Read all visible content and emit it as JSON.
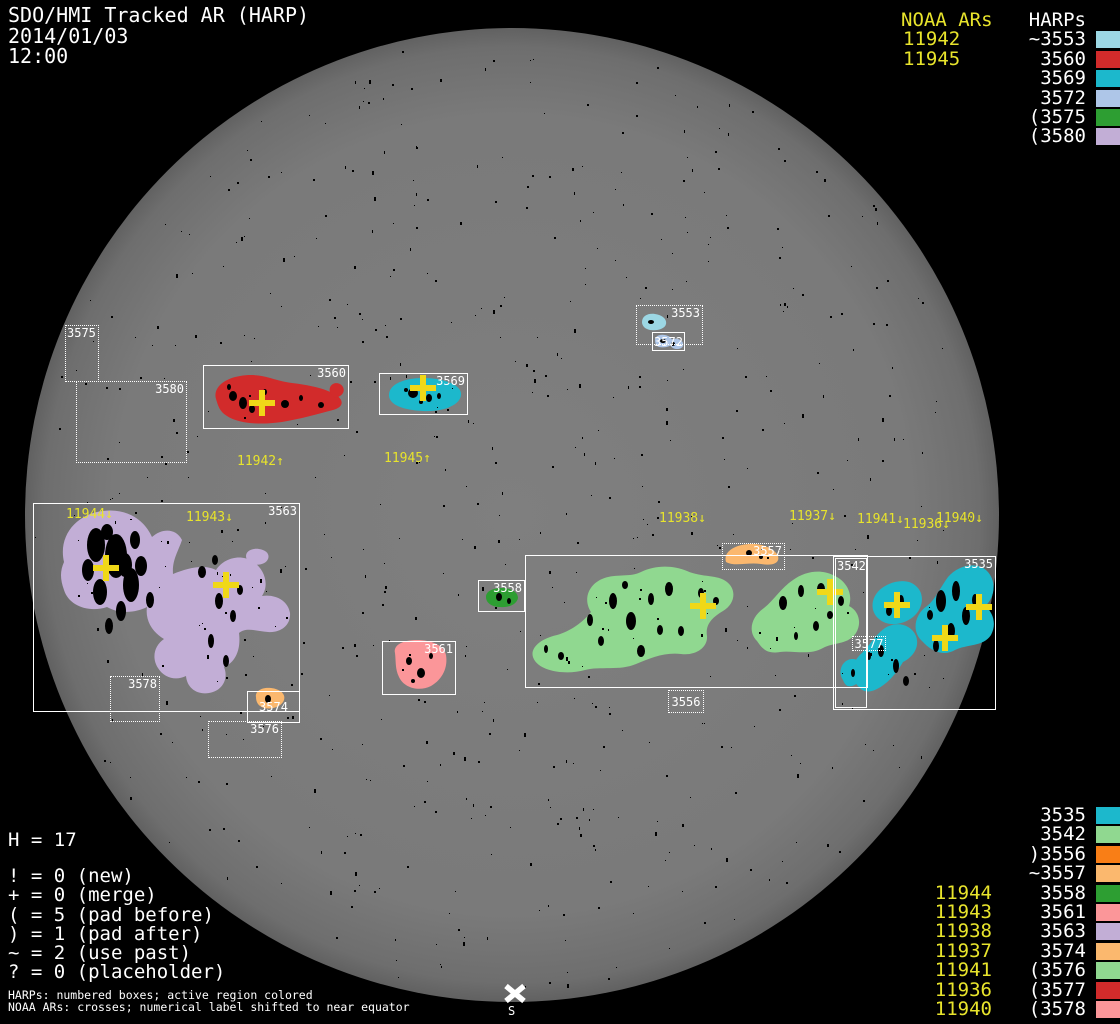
{
  "title": {
    "line1": "SDO/HMI Tracked AR (HARP)",
    "line2": "2014/01/03",
    "line3": "12:00"
  },
  "colors": {
    "background": "#000000",
    "disk_center": "#7f7f7f",
    "disk_edge": "#636363",
    "box_border": "#ffffff",
    "label_text": "#ffffff",
    "noaa_yellow": "#e8e42c",
    "cross_yellow": "#f0d818"
  },
  "top_right": {
    "noaa_header": "NOAA ARs",
    "noaa_items": [
      "11942",
      "11945"
    ],
    "harps_header": "HARPs",
    "harps_items": [
      {
        "label": "~3553",
        "color": "#9cd7e4"
      },
      {
        "label": "3560",
        "color": "#d22b2b"
      },
      {
        "label": "3569",
        "color": "#1cb8cc"
      },
      {
        "label": "3572",
        "color": "#aec6e8"
      },
      {
        "label": "(3575",
        "color": "#2d9e32"
      },
      {
        "label": "(3580",
        "color": "#c2aed6"
      }
    ]
  },
  "bottom_right": {
    "harps_items": [
      {
        "label": "3535",
        "color": "#1cb8cc",
        "noaa": ""
      },
      {
        "label": "3542",
        "color": "#90d890",
        "noaa": ""
      },
      {
        "label": ")3556",
        "color": "#f97e16",
        "noaa": ""
      },
      {
        "label": "~3557",
        "color": "#fbb86e",
        "noaa": ""
      },
      {
        "label": "3558",
        "color": "#2d9e32",
        "noaa": "11944"
      },
      {
        "label": "3561",
        "color": "#fb9699",
        "noaa": "11943"
      },
      {
        "label": "3563",
        "color": "#c2aed6",
        "noaa": "11938"
      },
      {
        "label": "3574",
        "color": "#fbb86e",
        "noaa": "11937"
      },
      {
        "label": "(3576",
        "color": "#90d890",
        "noaa": "11941"
      },
      {
        "label": "(3577",
        "color": "#d22b2b",
        "noaa": "11936"
      },
      {
        "label": "(3578",
        "color": "#fb9699",
        "noaa": "11940"
      }
    ]
  },
  "stats": {
    "h_line": "H = 17",
    "lines": [
      "! = 0 (new)",
      "+ = 0 (merge)",
      "( = 5 (pad before)",
      ") = 1 (pad after)",
      "~ = 2 (use past)",
      "? = 0 (placeholder)"
    ]
  },
  "footer": {
    "line1": "HARPs: numbered boxes; active region colored",
    "line2": "NOAA ARs: crosses; numerical label shifted to near equator"
  },
  "south_marker": {
    "label": "S"
  },
  "disk": {
    "cx": 512,
    "cy": 515,
    "r": 487
  },
  "boxes": [
    {
      "id": "3575",
      "label": "3575",
      "x": 65,
      "y": 325,
      "w": 34,
      "h": 57,
      "style": "dotted",
      "label_pos": "tl"
    },
    {
      "id": "3580",
      "label": "3580",
      "x": 76,
      "y": 381,
      "w": 111,
      "h": 82,
      "style": "dotted",
      "label_pos": "tr"
    },
    {
      "id": "3553",
      "label": "3553",
      "x": 636,
      "y": 305,
      "w": 67,
      "h": 40,
      "style": "dotted",
      "label_pos": "tr"
    },
    {
      "id": "3572",
      "label": "3572",
      "x": 652,
      "y": 332,
      "w": 33,
      "h": 19,
      "style": "solid",
      "label_pos": "c"
    },
    {
      "id": "3560",
      "label": "3560",
      "x": 203,
      "y": 365,
      "w": 146,
      "h": 64,
      "style": "solid",
      "label_pos": "tr"
    },
    {
      "id": "3569",
      "label": "3569",
      "x": 379,
      "y": 373,
      "w": 89,
      "h": 42,
      "style": "solid",
      "label_pos": "tr"
    },
    {
      "id": "3563",
      "label": "3563",
      "x": 33,
      "y": 503,
      "w": 267,
      "h": 209,
      "style": "solid",
      "label_pos": "tr"
    },
    {
      "id": "3578",
      "label": "3578",
      "x": 110,
      "y": 676,
      "w": 50,
      "h": 46,
      "style": "dotted",
      "label_pos": "tr"
    },
    {
      "id": "3574",
      "label": "3574",
      "x": 247,
      "y": 691,
      "w": 53,
      "h": 32,
      "style": "solid",
      "label_pos": "c"
    },
    {
      "id": "3576",
      "label": "3576",
      "x": 208,
      "y": 721,
      "w": 74,
      "h": 37,
      "style": "dotted",
      "label_pos": "tr"
    },
    {
      "id": "3561",
      "label": "3561",
      "x": 382,
      "y": 641,
      "w": 74,
      "h": 54,
      "style": "solid",
      "label_pos": "tr"
    },
    {
      "id": "3558",
      "label": "3558",
      "x": 478,
      "y": 580,
      "w": 47,
      "h": 32,
      "style": "solid",
      "label_pos": "tr"
    },
    {
      "id": "3556-region",
      "label": "",
      "x": 525,
      "y": 555,
      "w": 343,
      "h": 133,
      "style": "solid",
      "label_pos": "none"
    },
    {
      "id": "3556",
      "label": "3556",
      "x": 668,
      "y": 690,
      "w": 36,
      "h": 23,
      "style": "dotted",
      "label_pos": "c"
    },
    {
      "id": "3557",
      "label": "3557",
      "x": 722,
      "y": 543,
      "w": 63,
      "h": 27,
      "style": "dotted",
      "label_pos": "tr"
    },
    {
      "id": "3535",
      "label": "3535",
      "x": 833,
      "y": 556,
      "w": 163,
      "h": 154,
      "style": "solid",
      "label_pos": "tr"
    },
    {
      "id": "3542",
      "label": "3542",
      "x": 835,
      "y": 558,
      "w": 32,
      "h": 150,
      "style": "solid",
      "label_pos": "tl"
    },
    {
      "id": "3577",
      "label": "3577",
      "x": 852,
      "y": 636,
      "w": 34,
      "h": 15,
      "style": "dotted",
      "label_pos": "c"
    }
  ],
  "crosses": [
    {
      "x": 262,
      "y": 403
    },
    {
      "x": 423,
      "y": 388
    },
    {
      "x": 106,
      "y": 568
    },
    {
      "x": 226,
      "y": 585
    },
    {
      "x": 703,
      "y": 606
    },
    {
      "x": 830,
      "y": 592
    },
    {
      "x": 897,
      "y": 605
    },
    {
      "x": 979,
      "y": 607
    },
    {
      "x": 945,
      "y": 638
    }
  ],
  "noaa_disk_labels": [
    {
      "text": "11942↑",
      "x": 237,
      "y": 455
    },
    {
      "text": "11945↑",
      "x": 384,
      "y": 452
    },
    {
      "text": "11944↓",
      "x": 66,
      "y": 508
    },
    {
      "text": "11943↓",
      "x": 186,
      "y": 511
    },
    {
      "text": "11938↓",
      "x": 659,
      "y": 512
    },
    {
      "text": "11937↓",
      "x": 789,
      "y": 510
    },
    {
      "text": "11941↓",
      "x": 857,
      "y": 513
    },
    {
      "text": "11936↓",
      "x": 903,
      "y": 518
    },
    {
      "text": "11940↓",
      "x": 936,
      "y": 512
    }
  ],
  "blobs": [
    {
      "id": "ar-3553",
      "fill": "#9cd7e4",
      "d": "M642,322 C642,316 648,313 655,314 C662,315 667,319 666,324 C665,329 657,331 650,330 C645,329 642,326 642,322 Z"
    },
    {
      "id": "ar-3572-a",
      "fill": "#aec6e8",
      "d": "M655,340 C655,336 660,334 665,335 C670,336 673,339 672,343 C671,347 664,348 659,347 C656,346 655,343 655,340 Z"
    },
    {
      "id": "ar-3572-b",
      "fill": "#aec6e8",
      "d": "M670,342 C670,339 674,338 678,339 C682,340 684,343 683,346 C682,349 676,350 673,348 C671,347 670,345 670,342 Z"
    },
    {
      "id": "ar-3560",
      "fill": "#d22b2b",
      "d": "M216,399 C213,389 222,379 240,376 C262,372 274,381 292,383 C308,385 325,388 336,395 C344,400 344,407 333,410 C318,414 300,419 282,422 C261,425 239,424 227,416 C219,411 218,405 216,399 Z"
    },
    {
      "id": "ar-3560-tail",
      "fill": "#d22b2b",
      "d": "M330,392 C328,386 334,381 340,384 C345,387 345,393 340,396 C335,399 332,397 330,392 Z"
    },
    {
      "id": "ar-3569",
      "fill": "#1cb8cc",
      "d": "M389,396 C388,385 403,378 423,378 C444,378 462,385 461,395 C460,405 444,412 423,411 C403,410 390,405 389,396 Z"
    },
    {
      "id": "ar-3563",
      "fill": "#c2aed6",
      "d": "M64,562 C58,536 76,514 103,511 C126,508 144,519 152,537 C162,528 176,528 182,540 C178,552 172,560 173,574 C188,568 204,564 216,570 C224,558 240,554 252,561 C264,568 270,584 262,596 C276,594 288,601 290,613 C291,625 281,633 268,632 C256,631 246,627 239,633 C241,649 236,662 224,667 C229,679 222,691 209,693 C197,695 187,688 186,676 C176,681 164,678 158,668 C151,657 155,645 164,639 C152,632 145,620 147,607 C135,613 119,614 107,607 C89,613 69,606 64,590 C60,579 60,571 64,562 Z"
    },
    {
      "id": "ar-3563-b",
      "fill": "#c2aed6",
      "d": "M246,556 C246,551 252,548 259,549 C266,550 270,554 268,559 C266,564 258,566 252,564 C248,562 246,559 246,556 Z"
    },
    {
      "id": "ar-3561",
      "fill": "#fb9699",
      "d": "M395,653 C393,645 403,640 417,640 C431,640 444,645 446,655 C448,667 443,679 431,686 C419,692 404,688 399,677 C395,669 396,661 395,653 Z"
    },
    {
      "id": "ar-3558",
      "fill": "#2d9e32",
      "d": "M486,597 C486,591 493,588 502,588 C511,588 518,592 518,598 C517,604 509,608 500,607 C492,607 486,603 486,597 Z"
    },
    {
      "id": "ar-3556-a",
      "fill": "#90d890",
      "d": "M535,661 C527,650 539,639 557,635 C571,631 583,622 591,612 C583,600 588,585 602,579 C616,573 629,578 641,572 C655,565 673,565 687,571 C703,578 717,574 727,582 C737,590 735,604 723,611 C713,617 705,624 707,636 C708,648 695,656 681,654 C665,652 650,658 636,664 C620,671 600,666 585,670 C567,675 543,672 535,661 Z"
    },
    {
      "id": "ar-3556-b",
      "fill": "#90d890",
      "d": "M757,641 C747,631 752,616 764,608 C774,600 781,588 793,580 C805,571 821,569 833,575 C847,581 853,594 849,606 C859,611 862,623 856,633 C848,645 834,642 823,648 C809,656 792,650 780,652 C768,654 763,650 757,641 Z"
    },
    {
      "id": "ar-3557",
      "fill": "#fbb86e",
      "d": "M726,562 C723,552 734,545 749,544 C763,543 775,549 778,556 C780,563 773,566 761,564 C747,562 735,567 726,562 Z"
    },
    {
      "id": "ar-3574",
      "fill": "#fbb86e",
      "d": "M256,697 C255,691 262,687 271,688 C280,689 286,694 284,700 C282,706 273,710 264,708 C258,706 256,702 256,697 Z"
    },
    {
      "id": "ar-3535-a",
      "fill": "#1cb8cc",
      "d": "M879,619 C869,611 871,596 882,588 C893,580 909,578 917,587 C925,595 923,609 913,617 C903,625 888,627 879,619 Z"
    },
    {
      "id": "ar-3535-b",
      "fill": "#1cb8cc",
      "d": "M922,641 C911,631 915,614 927,606 C935,600 940,588 948,577 C958,565 977,561 987,571 C997,581 995,598 985,606 C993,612 997,624 991,635 C983,647 967,644 955,650 C943,657 931,651 922,641 Z"
    },
    {
      "id": "ar-3535-c",
      "fill": "#1cb8cc",
      "d": "M859,687 C848,677 852,661 862,653 C870,645 875,635 885,628 C896,621 911,624 916,636 C920,647 913,657 903,662 C897,672 889,683 877,689 C869,693 863,692 859,687 Z"
    },
    {
      "id": "ar-3535-d",
      "fill": "#1cb8cc",
      "d": "M843,680 C838,673 841,663 848,660 C855,657 862,661 863,669 C864,677 859,684 852,686 C847,687 845,685 843,680 Z"
    }
  ],
  "sunspots": [
    [
      96,
      545,
      9,
      17
    ],
    [
      116,
      556,
      11,
      22
    ],
    [
      131,
      585,
      8,
      17
    ],
    [
      100,
      592,
      7,
      13
    ],
    [
      88,
      570,
      6,
      11
    ],
    [
      141,
      566,
      6,
      10
    ],
    [
      121,
      611,
      5,
      10
    ],
    [
      109,
      626,
      4,
      8
    ],
    [
      135,
      540,
      5,
      9
    ],
    [
      107,
      532,
      6,
      8
    ],
    [
      150,
      600,
      4,
      8
    ],
    [
      125,
      565,
      7,
      12
    ],
    [
      219,
      601,
      4,
      8
    ],
    [
      233,
      616,
      3,
      6
    ],
    [
      211,
      641,
      3,
      7
    ],
    [
      226,
      661,
      3,
      6
    ],
    [
      202,
      572,
      4,
      6
    ],
    [
      240,
      590,
      3,
      5
    ],
    [
      215,
      560,
      3,
      5
    ],
    [
      233,
      396,
      4,
      5
    ],
    [
      243,
      403,
      4,
      6
    ],
    [
      252,
      409,
      3,
      4
    ],
    [
      285,
      404,
      4,
      4
    ],
    [
      301,
      398,
      2,
      3
    ],
    [
      321,
      405,
      3,
      3
    ],
    [
      229,
      387,
      2,
      3
    ],
    [
      265,
      392,
      2,
      3
    ],
    [
      413,
      393,
      5,
      5
    ],
    [
      429,
      398,
      3,
      4
    ],
    [
      439,
      396,
      2,
      3
    ],
    [
      406,
      390,
      2,
      2
    ],
    [
      421,
      402,
      2,
      2
    ],
    [
      613,
      601,
      4,
      8
    ],
    [
      631,
      621,
      5,
      9
    ],
    [
      651,
      599,
      3,
      6
    ],
    [
      669,
      589,
      4,
      7
    ],
    [
      701,
      593,
      3,
      5
    ],
    [
      641,
      651,
      4,
      6
    ],
    [
      601,
      641,
      3,
      5
    ],
    [
      681,
      631,
      3,
      5
    ],
    [
      561,
      656,
      3,
      4
    ],
    [
      546,
      649,
      2,
      4
    ],
    [
      716,
      601,
      3,
      4
    ],
    [
      590,
      620,
      3,
      6
    ],
    [
      660,
      630,
      3,
      5
    ],
    [
      625,
      585,
      3,
      4
    ],
    [
      783,
      603,
      4,
      7
    ],
    [
      801,
      591,
      3,
      6
    ],
    [
      821,
      589,
      4,
      6
    ],
    [
      841,
      601,
      3,
      5
    ],
    [
      816,
      626,
      3,
      5
    ],
    [
      796,
      636,
      2,
      4
    ],
    [
      830,
      615,
      3,
      4
    ],
    [
      749,
      553,
      3,
      3
    ],
    [
      761,
      557,
      2,
      2
    ],
    [
      409,
      661,
      3,
      4
    ],
    [
      421,
      673,
      4,
      5
    ],
    [
      431,
      656,
      2,
      3
    ],
    [
      413,
      681,
      2,
      2
    ],
    [
      499,
      597,
      3,
      4
    ],
    [
      509,
      601,
      2,
      3
    ],
    [
      268,
      699,
      3,
      4
    ],
    [
      901,
      601,
      3,
      6
    ],
    [
      889,
      611,
      3,
      5
    ],
    [
      941,
      601,
      5,
      11
    ],
    [
      956,
      591,
      4,
      10
    ],
    [
      966,
      616,
      4,
      9
    ],
    [
      951,
      631,
      4,
      8
    ],
    [
      936,
      646,
      3,
      6
    ],
    [
      881,
      651,
      3,
      6
    ],
    [
      896,
      666,
      3,
      7
    ],
    [
      906,
      681,
      3,
      5
    ],
    [
      869,
      656,
      2,
      4
    ],
    [
      853,
      673,
      2,
      4
    ],
    [
      975,
      600,
      3,
      6
    ],
    [
      930,
      615,
      3,
      5
    ],
    [
      651,
      322,
      3,
      2
    ],
    [
      663,
      341,
      3,
      2
    ],
    [
      673,
      344,
      2,
      2
    ]
  ],
  "speckles": {
    "seed": 1337,
    "count": 640,
    "r": 478
  },
  "chart_data": {
    "type": "scatter",
    "title": "SDO/HMI Tracked AR (HARP)",
    "date": "2014/01/03",
    "time": "12:00",
    "h_count": 17,
    "status_counts": {
      "new": 0,
      "merge": 0,
      "pad_before": 5,
      "pad_after": 1,
      "use_past": 2,
      "placeholder": 0
    },
    "harps": [
      {
        "harp": "3553",
        "prefix": "~",
        "color": "#9cd7e4"
      },
      {
        "harp": "3560",
        "prefix": "",
        "color": "#d22b2b"
      },
      {
        "harp": "3569",
        "prefix": "",
        "color": "#1cb8cc"
      },
      {
        "harp": "3572",
        "prefix": "",
        "color": "#aec6e8"
      },
      {
        "harp": "3575",
        "prefix": "(",
        "color": "#2d9e32"
      },
      {
        "harp": "3580",
        "prefix": "(",
        "color": "#c2aed6"
      },
      {
        "harp": "3535",
        "prefix": "",
        "color": "#1cb8cc"
      },
      {
        "harp": "3542",
        "prefix": "",
        "color": "#90d890"
      },
      {
        "harp": "3556",
        "prefix": ")",
        "color": "#f97e16"
      },
      {
        "harp": "3557",
        "prefix": "~",
        "color": "#fbb86e"
      },
      {
        "harp": "3558",
        "prefix": "",
        "color": "#2d9e32",
        "noaa": "11944"
      },
      {
        "harp": "3561",
        "prefix": "",
        "color": "#fb9699",
        "noaa": "11943"
      },
      {
        "harp": "3563",
        "prefix": "",
        "color": "#c2aed6",
        "noaa": "11938"
      },
      {
        "harp": "3574",
        "prefix": "",
        "color": "#fbb86e",
        "noaa": "11937"
      },
      {
        "harp": "3576",
        "prefix": "(",
        "color": "#90d890",
        "noaa": "11941"
      },
      {
        "harp": "3577",
        "prefix": "(",
        "color": "#d22b2b",
        "noaa": "11936"
      },
      {
        "harp": "3578",
        "prefix": "(",
        "color": "#fb9699",
        "noaa": "11940"
      }
    ],
    "noaa_ars_top": [
      "11942",
      "11945"
    ],
    "cross_positions": [
      [
        262,
        403
      ],
      [
        423,
        388
      ],
      [
        106,
        568
      ],
      [
        226,
        585
      ],
      [
        703,
        606
      ],
      [
        830,
        592
      ],
      [
        897,
        605
      ],
      [
        979,
        607
      ],
      [
        945,
        638
      ]
    ]
  }
}
